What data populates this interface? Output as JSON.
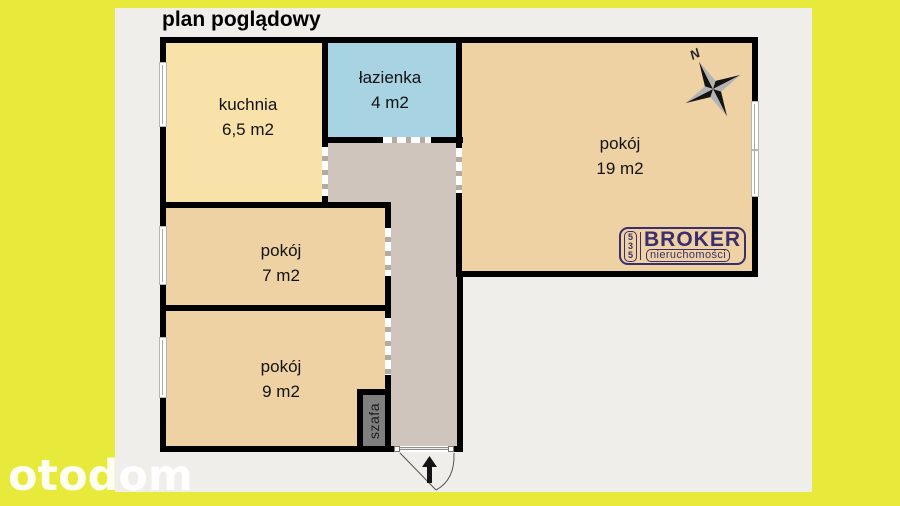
{
  "header": {
    "title": "plan poglądowy"
  },
  "rooms": [
    {
      "name": "kuchnia",
      "area": "6,5 m2"
    },
    {
      "name": "łazienka",
      "area": "4 m2"
    },
    {
      "name": "pokój",
      "area": "19 m2"
    },
    {
      "name": "pokój",
      "area": "7 m2"
    },
    {
      "name": "pokój",
      "area": "9 m2"
    }
  ],
  "closet": {
    "label": "szafa"
  },
  "compass": {
    "north": "N"
  },
  "agency_logo": {
    "digits": [
      "5",
      "3",
      "5"
    ],
    "name": "BROKER",
    "subtitle": "nieruchomości"
  },
  "watermark": {
    "text": "otodom"
  },
  "colors": {
    "frame": "#e7ea3b",
    "paper": "#f0eeea",
    "kitchen": "#f8e2aa",
    "bathroom": "#a7d3e2",
    "room": "#eed2a4",
    "corridor": "#d0c5bc",
    "closet": "#7f7f7f",
    "wall": "#000000",
    "logo": "#3b2d6e"
  }
}
